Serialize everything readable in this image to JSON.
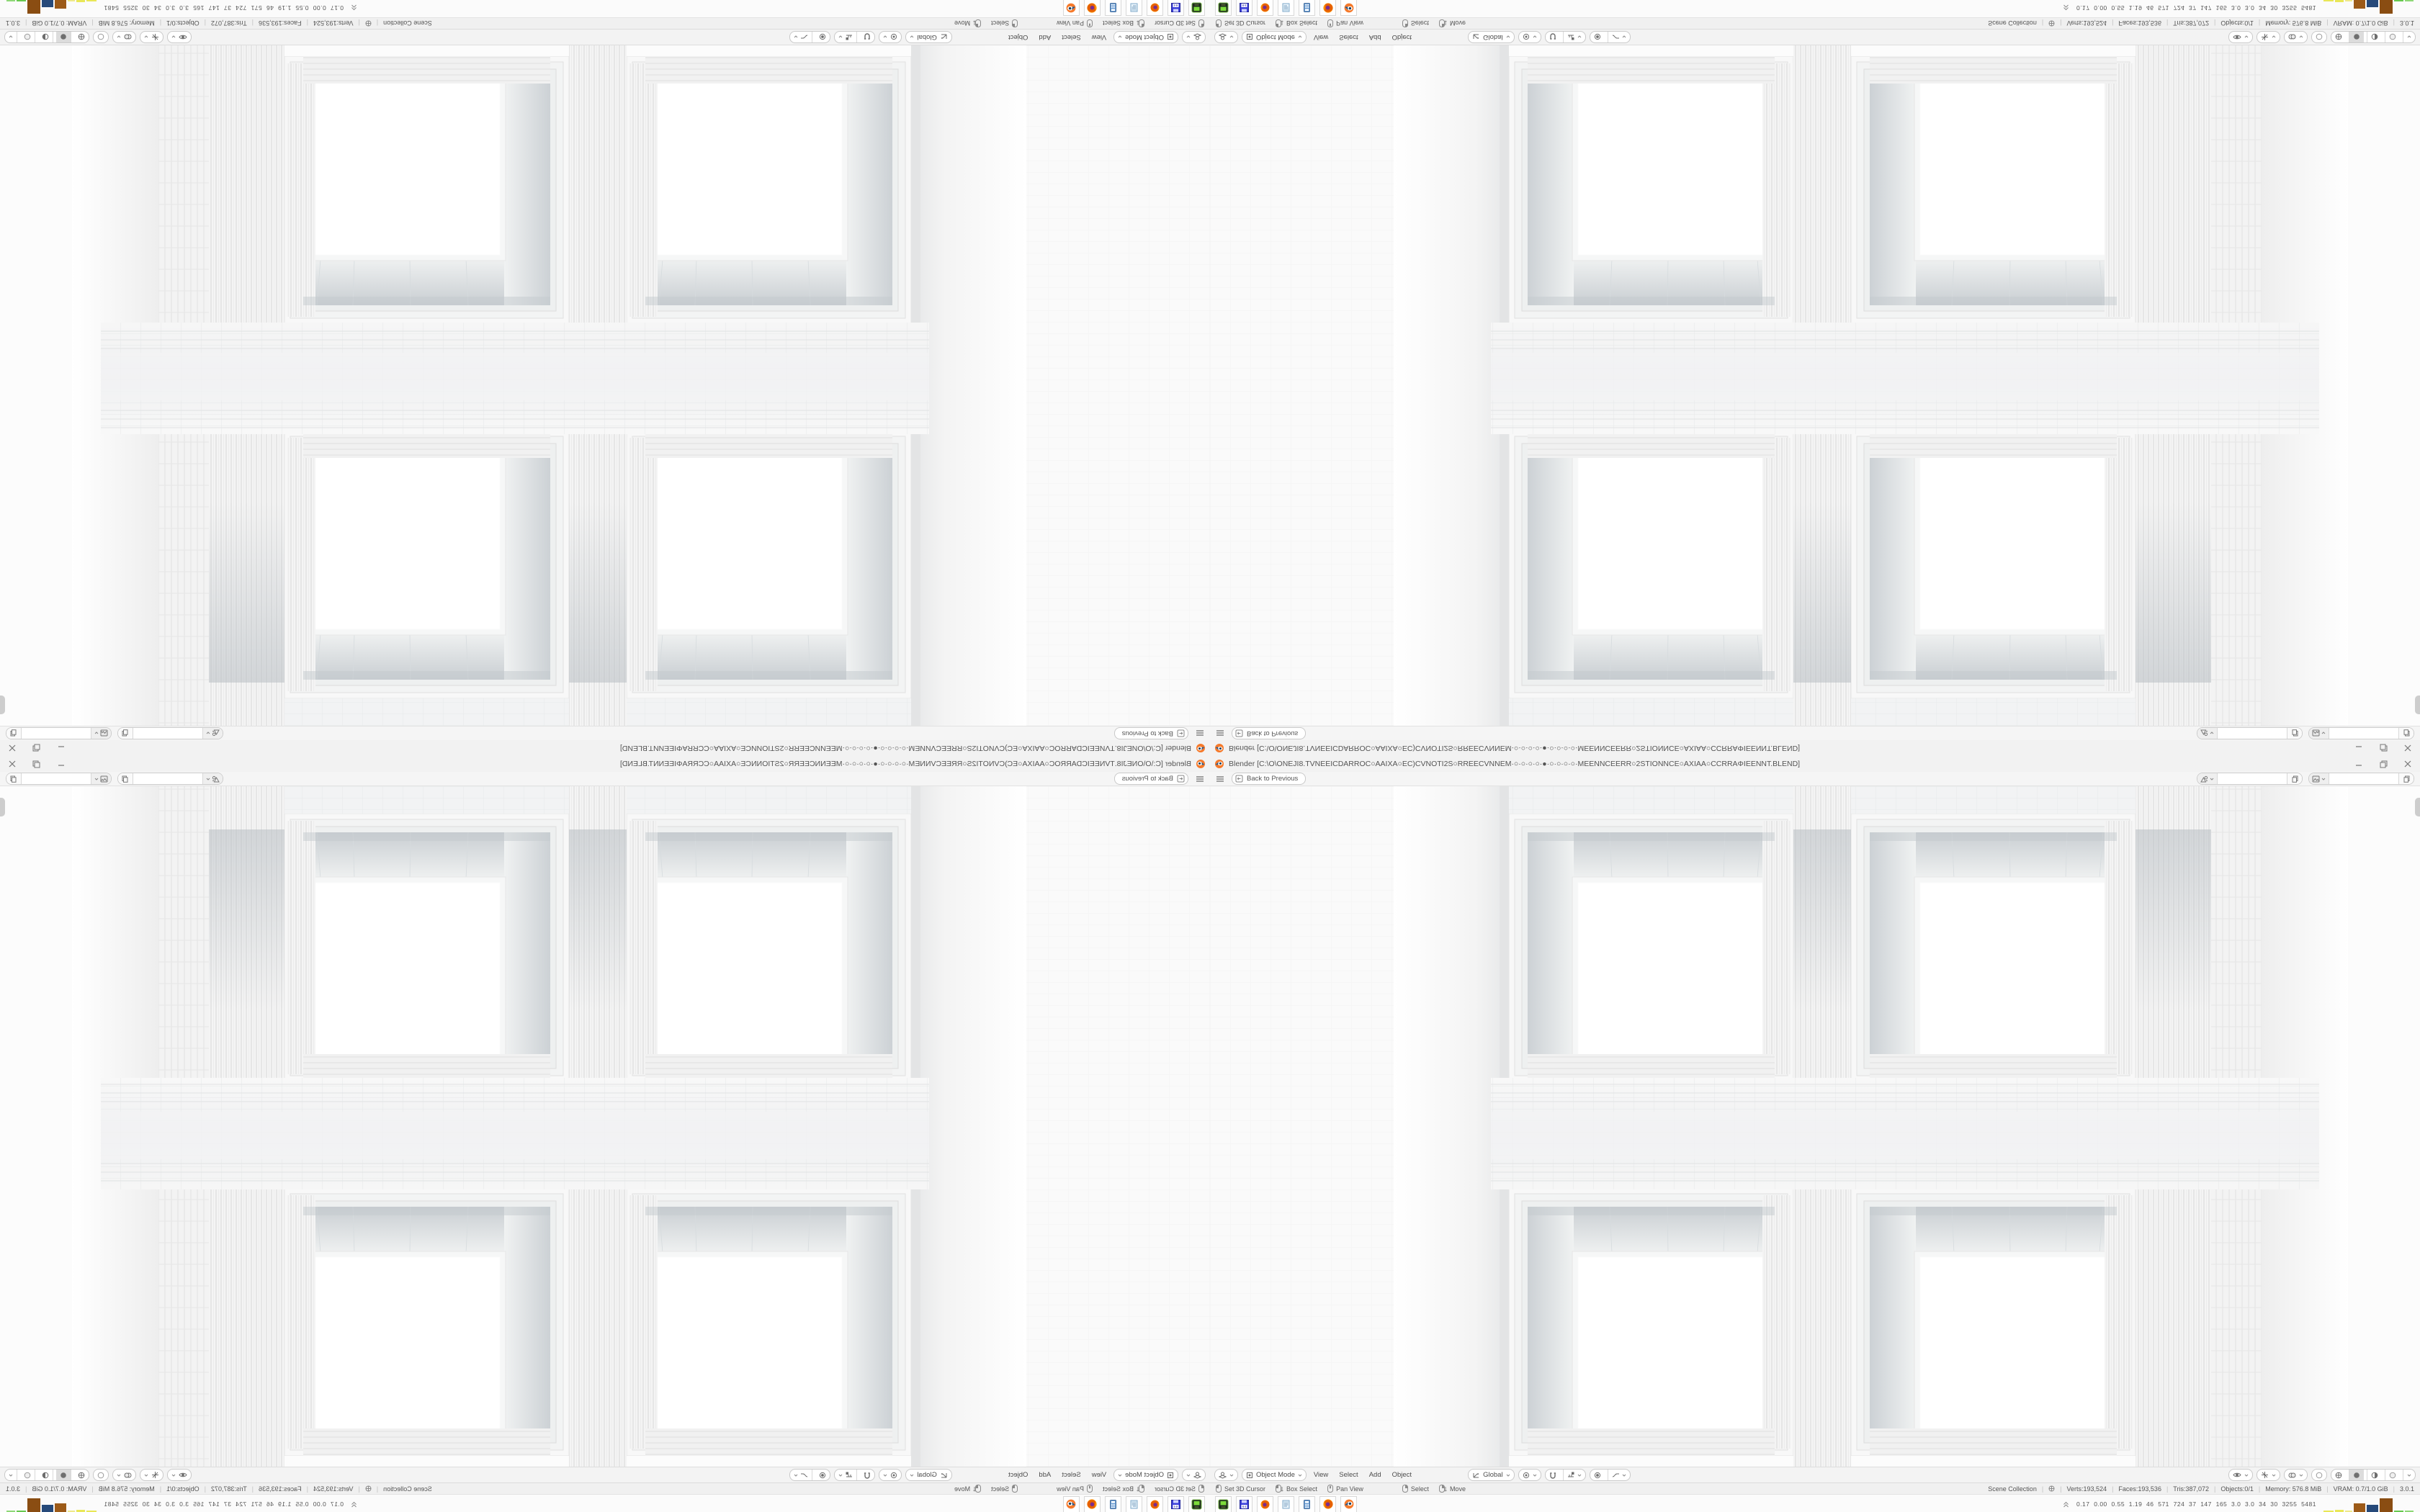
{
  "window": {
    "title": "Blender [C:\\O\\ONEJI8.TVNEEICDARROC○AAIXA○EC)CVNOTI2S○RREECVNNEM·○·○·○·○·●·○·○·○·○·MEENNCEERR○2STIONNCE○AXIAA○CCRRAΦIEENNT.BLEND]",
    "topbar": {
      "back": "Back to Previous"
    },
    "viewport_header": {
      "mode": "Object Mode",
      "menus": [
        "View",
        "Select",
        "Add",
        "Object"
      ],
      "orientation": "Global"
    },
    "statusbar": {
      "hints": [
        "Set 3D Cursor",
        "Box Select",
        "Pan View",
        "Select",
        "Move"
      ],
      "stats": [
        "Scene Collection",
        "Verts:193,524",
        "Faces:193,536",
        "Tris:387,072",
        "Objects:0/1",
        "Memory: 576.8 MiB",
        "VRAM: 0.7/1.0 GiB",
        "3.0.1"
      ]
    },
    "taskbar": {
      "apps": [
        "screen-recorder",
        "installer-x64",
        "firefox",
        "notepad",
        "calculator",
        "firefox-developer",
        "blender"
      ],
      "floppy_label": "64",
      "perf_values": [
        "0.17",
        "0.00",
        "0.55",
        "1.19",
        "46",
        "571",
        "724",
        "37",
        "147",
        "165",
        "3.0",
        "3.0",
        "34",
        "30",
        "3255",
        "5481"
      ]
    },
    "colors": {
      "accent_orange": "#f5792a",
      "bar_yellow": "#e9e757",
      "bar_brown": "#9c5a18",
      "bar_blue": "#274a7a",
      "bar_green": "#67c94f"
    }
  }
}
